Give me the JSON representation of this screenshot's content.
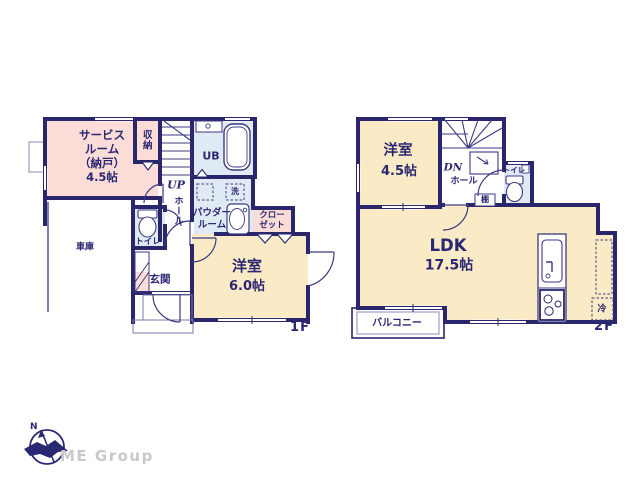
{
  "branding": {
    "company": "ME Group",
    "north": "N"
  },
  "f1": {
    "floor_label": "1F",
    "service_room": "サービス\nルーム\n（納戸）\n4.5帖",
    "storage": "収納",
    "stairs": "UP",
    "hall": "ホール",
    "unit_bath": "UB",
    "laundry": "洗",
    "powder_room": "パウダー\nルーム",
    "closet": "クロー\nゼット",
    "western_room": "洋室",
    "western_room_area": "6.0帖",
    "toilet": "トイレ",
    "entrance": "玄関",
    "garage": "車庫"
  },
  "f2": {
    "floor_label": "2F",
    "western_room": "洋室",
    "western_room_area": "4.5帖",
    "stairs": "DN",
    "hall": "ホール",
    "toilet": "トイレ",
    "shelf": "棚",
    "ldk": "LDK",
    "ldk_area": "17.5帖",
    "balcony": "バルコニー",
    "refrigerator": "冷"
  },
  "colors": {
    "wall": "#29266b",
    "room_pink": "#fbdcd7",
    "room_cream": "#faeac5",
    "room_blue": "#e0eaf5",
    "text_navy": "#2b2873",
    "logo_gray": "#c9c9c9"
  }
}
